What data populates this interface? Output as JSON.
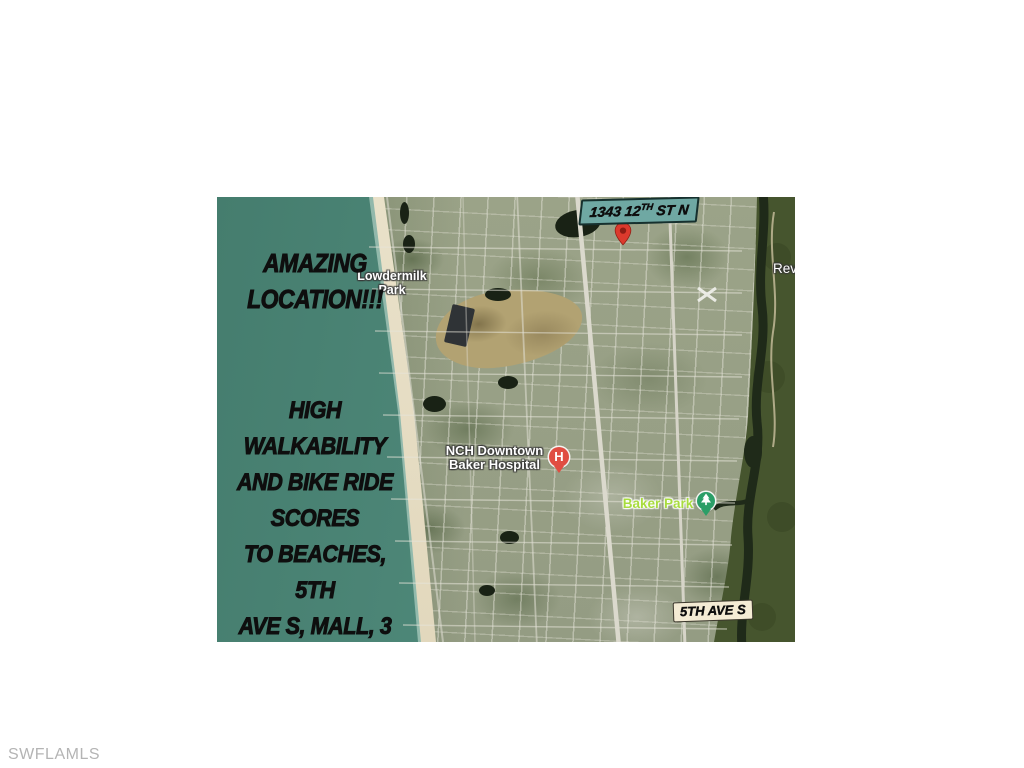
{
  "page": {
    "watermark": "SWFLAMLS"
  },
  "map": {
    "headline": {
      "line1": "AMAZING",
      "line2": "LOCATION!!!"
    },
    "body_lines": [
      "HIGH WALKABILITY",
      "AND BIKE RIDE",
      "SCORES",
      "TO BEACHES, 5TH",
      "AVE S, MALL, 3",
      "DIFFERENT PARKS, &",
      "SCHOOLS!"
    ],
    "address_tag": {
      "pre": "1343 12",
      "sup": "TH",
      "post": " ST N"
    },
    "street_tag": "5TH AVE S",
    "labels": {
      "lowdermilk_line1": "Lowdermilk",
      "lowdermilk_line2": "Park",
      "hospital_line1": "NCH Downtown",
      "hospital_line2": "Baker Hospital",
      "baker_park": "Baker Park",
      "edge_partial": "Revs"
    },
    "icons": {
      "hospital_letter": "H"
    },
    "colors": {
      "ocean": "#4f897a",
      "sand": "#e6ddc4",
      "urban": "#99a189",
      "golf_course": "#b2a272",
      "mangrove": "#46552e",
      "river": "#1f2a19",
      "address_tag_bg": "#6fa8a3",
      "street_tag_bg": "#f4ebd4",
      "location_pin_red": "#dc3a2d",
      "hospital_pin_red": "#e04d42",
      "park_pin_green": "#2b9e67",
      "baker_park_text": "#a8dc3e",
      "overlay_text": "#0e0e0e",
      "watermark_gray": "#b4b4b4"
    }
  }
}
